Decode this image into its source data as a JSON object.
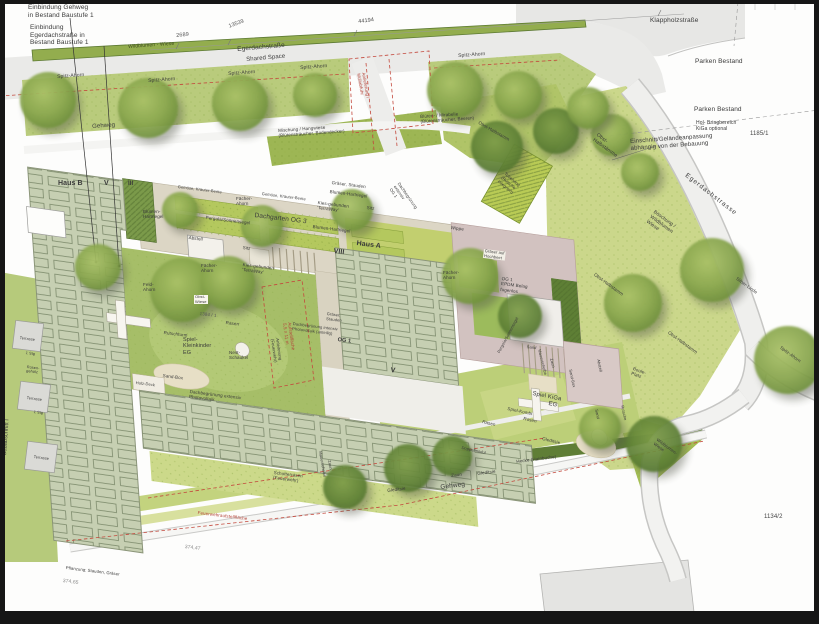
{
  "colors": {
    "street_gray": "#eaeae8",
    "lawn_green": "#cbd78b",
    "roof_sage": "#c6cfb2",
    "bed_green": "#b4c85e",
    "wildflower_strip": "#93ad4e",
    "hedge_dark": "#5f7e36",
    "epdm_mauve": "#d2c2c0",
    "annotation_red": "#b5463b"
  },
  "labels": [
    {
      "n": "note-einbindung-gehweg",
      "t": "Einbindung Gehweg\nin Bestand Baustufe 1",
      "x": 28,
      "y": 4,
      "s": 6.5
    },
    {
      "n": "note-einbindung-egerdachstrasse",
      "t": "Einbindung\nEgerdachstraße in\nBestand Baustufe 1",
      "x": 30,
      "y": 24,
      "s": 6.5
    },
    {
      "n": "dim-2689",
      "t": "2689",
      "x": 176,
      "y": 33,
      "r": -6,
      "s": 5.5,
      "c": "#555"
    },
    {
      "n": "dim-13539",
      "t": "13539",
      "x": 228,
      "y": 24,
      "r": -20,
      "s": 5.5,
      "c": "#555"
    },
    {
      "n": "dim-44194",
      "t": "44194",
      "x": 358,
      "y": 19,
      "r": -7,
      "s": 5.5,
      "c": "#444"
    },
    {
      "n": "wildblumen-wiese-top",
      "t": "Wildblumen - Wiese",
      "x": 128,
      "y": 45,
      "r": -4,
      "s": 5,
      "c": "#3c4a1e"
    },
    {
      "n": "street-egerdachstrasse",
      "t": "Egerdachstraße",
      "x": 237,
      "y": 46,
      "r": -5,
      "s": 6.5
    },
    {
      "n": "street-shared-space",
      "t": "Shared Space",
      "x": 246,
      "y": 57,
      "r": -5,
      "s": 6
    },
    {
      "n": "tree-spitz-ahorn-1",
      "t": "Spitz-Ahorn",
      "x": 57,
      "y": 75,
      "r": -4,
      "s": 5
    },
    {
      "n": "tree-spitz-ahorn-2",
      "t": "Spitz-Ahorn",
      "x": 148,
      "y": 79,
      "r": -4,
      "s": 5
    },
    {
      "n": "tree-spitz-ahorn-3",
      "t": "Spitz-Ahorn",
      "x": 228,
      "y": 72,
      "r": -4,
      "s": 5
    },
    {
      "n": "tree-spitz-ahorn-4",
      "t": "Spitz-Ahorn",
      "x": 300,
      "y": 66,
      "r": -4,
      "s": 5
    },
    {
      "n": "tree-spitz-ahorn-5",
      "t": "Spitz-Ahorn",
      "x": 458,
      "y": 54,
      "r": -4,
      "s": 5
    },
    {
      "n": "gehweg-nord",
      "t": "Gehweg",
      "x": 92,
      "y": 124,
      "r": -4,
      "s": 6
    },
    {
      "n": "street-klappholzstrasse",
      "t": "Klappholzstraße",
      "x": 650,
      "y": 17,
      "s": 6.5
    },
    {
      "n": "parken-bestand-1",
      "t": "Parken Bestand",
      "x": 695,
      "y": 58,
      "s": 6.5
    },
    {
      "n": "parken-bestand-2",
      "t": "Parken Bestand",
      "x": 694,
      "y": 106,
      "s": 6.5
    },
    {
      "n": "hol-bringbereich",
      "t": "Hol- Bringbereich\nKiGa optional",
      "x": 696,
      "y": 121,
      "s": 5
    },
    {
      "n": "parcel-1185-1",
      "t": "1185/1",
      "x": 750,
      "y": 131,
      "s": 6,
      "c": "#444"
    },
    {
      "n": "note-einschnitt",
      "t": "Einschnitt/Geländeanpassung\nabhängig von der Bebauung",
      "x": 630,
      "y": 139,
      "r": -4,
      "s": 6
    },
    {
      "n": "street-egerdachstrasse-diag",
      "t": "Egerdachstrasse",
      "x": 688,
      "y": 172,
      "r": 38,
      "s": 6.5,
      "ls": 1
    },
    {
      "n": "boeschung-wildblumen",
      "t": "Böschung /\nWildblumen\nWiese",
      "x": 655,
      "y": 210,
      "r": 36,
      "s": 5
    },
    {
      "n": "obst-halbstaemme",
      "t": "Obst-\nHalbstämme",
      "x": 598,
      "y": 133,
      "r": 36,
      "s": 5
    },
    {
      "n": "obst-halbstamm-1",
      "t": "Obst-Halbstamm",
      "x": 480,
      "y": 120,
      "r": 30,
      "s": 4.5
    },
    {
      "n": "obst-halbstamm-2",
      "t": "Obst-Halbstamm",
      "x": 596,
      "y": 272,
      "r": 36,
      "s": 4.5
    },
    {
      "n": "obst-halbstamm-3",
      "t": "Obst-Halbstamm",
      "x": 670,
      "y": 330,
      "r": 36,
      "s": 4.5
    },
    {
      "n": "tree-silber-linde",
      "t": "Silber-Linde",
      "x": 738,
      "y": 276,
      "r": 36,
      "s": 4.5
    },
    {
      "n": "tree-spitz-ahorn-6",
      "t": "Spitz-Ahorn",
      "x": 782,
      "y": 345,
      "r": 36,
      "s": 4.5
    },
    {
      "n": "anlieferung-red",
      "t": "Anlieferung /\nMüllabfuhr",
      "x": 366,
      "y": 72,
      "r": 80,
      "s": 4.5,
      "c": "#b5463b"
    },
    {
      "n": "mischung-hangwiese",
      "t": "Mischung / Hangwiese\n(Blütensträucher, Bodendecker)",
      "x": 278,
      "y": 128,
      "r": -4,
      "s": 4.5
    },
    {
      "n": "blueten-mirabelle",
      "t": "Blüten- / Mirabelle\n(Blütensträucher, Beeren)",
      "x": 420,
      "y": 114,
      "r": -4,
      "s": 4.5
    },
    {
      "n": "haus-b",
      "t": "Haus B",
      "x": 58,
      "y": 180,
      "s": 7,
      "w": 700
    },
    {
      "n": "haus-b-geschosse",
      "t": "V",
      "x": 104,
      "y": 180,
      "s": 7,
      "w": 700
    },
    {
      "n": "roemisch-iii",
      "t": "III",
      "x": 128,
      "y": 181,
      "s": 6,
      "w": 700
    },
    {
      "n": "gemuese-beete-1",
      "t": "Gemüse, Kräuter-Beete",
      "x": 178,
      "y": 185,
      "r": 7,
      "s": 4
    },
    {
      "n": "gemuese-beete-2",
      "t": "Gemüse, Kräuter-Beete",
      "x": 262,
      "y": 192,
      "r": 7,
      "s": 4
    },
    {
      "n": "pergola-sonnensegel-1",
      "t": "Pergola/Sonnensegel",
      "x": 206,
      "y": 215,
      "r": 7,
      "s": 4.5
    },
    {
      "n": "dachgarten-og3",
      "t": "Dachgarten OG 3",
      "x": 255,
      "y": 212,
      "r": 7,
      "s": 6.5
    },
    {
      "n": "blumen-hartriegel-1",
      "t": "Blumen-\nHartriegel",
      "x": 143,
      "y": 209,
      "s": 4.5
    },
    {
      "n": "graeser-stauden-1",
      "t": "Gräser, Stauden",
      "x": 332,
      "y": 180,
      "r": 7,
      "s": 4.5
    },
    {
      "n": "blumen-hartriegel-2",
      "t": "Blumen-Hartriegel",
      "x": 330,
      "y": 189,
      "r": 7,
      "s": 4.5
    },
    {
      "n": "blumen-hartriegel-3",
      "t": "Blumen-Hartriegel",
      "x": 313,
      "y": 224,
      "r": 7,
      "s": 4.5
    },
    {
      "n": "abstell-1",
      "t": "Abstell",
      "x": 189,
      "y": 235,
      "r": 7,
      "s": 4.5
    },
    {
      "n": "sitz-1",
      "t": "Sitz",
      "x": 243,
      "y": 245,
      "r": 7,
      "s": 4.5
    },
    {
      "n": "sitz-2",
      "t": "Sitz",
      "x": 367,
      "y": 205,
      "r": 7,
      "s": 4.5
    },
    {
      "n": "kies-terraway-1",
      "t": "Kies-gebunden\n'TerraWay'",
      "x": 318,
      "y": 200,
      "r": 7,
      "s": 4.5
    },
    {
      "n": "kies-terraway-2",
      "t": "Kies-gebunden\n'TerraWay'",
      "x": 243,
      "y": 262,
      "r": 7,
      "s": 4.5
    },
    {
      "n": "faecher-ahorn-1",
      "t": "Fächer-\nAhorn",
      "x": 236,
      "y": 196,
      "s": 4.5
    },
    {
      "n": "faecher-ahorn-2",
      "t": "Fächer-\nAhorn",
      "x": 201,
      "y": 263,
      "s": 4.5
    },
    {
      "n": "faecher-ahorn-3",
      "t": "Fächer-\nAhorn",
      "x": 443,
      "y": 270,
      "s": 4.5
    },
    {
      "n": "feld-ahorn",
      "t": "Feld-\nAhorn",
      "x": 143,
      "y": 282,
      "s": 4.5
    },
    {
      "n": "obst-wiese",
      "t": "Obst-\nWiese",
      "x": 194,
      "y": 295,
      "s": 4,
      "bg": "#f8f6ee"
    },
    {
      "n": "parcel-1384-1",
      "t": "1384 / 1",
      "x": 200,
      "y": 311,
      "r": 7,
      "s": 4.5,
      "c": "#555"
    },
    {
      "n": "rasen-hof",
      "t": "Rasen",
      "x": 226,
      "y": 320,
      "r": 7,
      "s": 4.5
    },
    {
      "n": "rutschturm",
      "t": "Rutschturm",
      "x": 164,
      "y": 330,
      "r": 7,
      "s": 4.5
    },
    {
      "n": "spiel-kleinkinder",
      "t": "Spiel-\nKleinkinder\nEG",
      "x": 183,
      "y": 337,
      "s": 5.5
    },
    {
      "n": "nest-schaukel",
      "t": "Nest-\nSchaukel",
      "x": 229,
      "y": 350,
      "s": 4.5
    },
    {
      "n": "sand-box-hof",
      "t": "Sand-Box",
      "x": 163,
      "y": 373,
      "r": 7,
      "s": 4.5
    },
    {
      "n": "holz-deck",
      "t": "Holz-Deck",
      "x": 136,
      "y": 381,
      "r": 7,
      "s": 4
    },
    {
      "n": "haus-a-geschosse",
      "t": "VIII",
      "x": 334,
      "y": 248,
      "r": 7,
      "s": 7,
      "w": 700
    },
    {
      "n": "haus-a",
      "t": "Haus A",
      "x": 357,
      "y": 240,
      "r": 7,
      "s": 7,
      "w": 700
    },
    {
      "n": "haus-a-v",
      "t": "V",
      "x": 391,
      "y": 367,
      "r": 7,
      "s": 7,
      "w": 700
    },
    {
      "n": "og1-haus-a",
      "t": "OG 1",
      "x": 338,
      "y": 337,
      "r": 7,
      "s": 5.5,
      "w": 700
    },
    {
      "n": "dachbegruenung-intensiv",
      "t": "Dachbegrünung intensiv\nPhotovoltaik (anteilig)",
      "x": 293,
      "y": 322,
      "r": 7,
      "s": 4
    },
    {
      "n": "graeser-stauden-2",
      "t": "Gräser,\nStauden",
      "x": 327,
      "y": 312,
      "r": 7,
      "s": 4
    },
    {
      "n": "dachbegruenung-extensiv-og1",
      "t": "Dachbegrünung\nextensiv\nOG 1",
      "x": 400,
      "y": 182,
      "r": 55,
      "s": 4.2
    },
    {
      "n": "wippe",
      "t": "Wippe",
      "x": 451,
      "y": 225,
      "r": 7,
      "s": 4.5
    },
    {
      "n": "graeser-hochbeet",
      "t": "Gräser auf\nHochbeet",
      "x": 484,
      "y": 249,
      "r": 7,
      "s": 4,
      "bg": "#f2f0e7"
    },
    {
      "n": "og1-epdm",
      "t": "OG 1\nEPDM Belag\nfugenlos",
      "x": 502,
      "y": 276,
      "r": 7,
      "s": 4.5
    },
    {
      "n": "tobehang",
      "t": "Tobehang\n(Rutsche\nintegriert)",
      "x": 506,
      "y": 172,
      "r": 40,
      "s": 4.2
    },
    {
      "n": "pergola-sonnensegel-2",
      "t": "Pergola/Sonnensegel",
      "x": 497,
      "y": 352,
      "r": -62,
      "s": 4
    },
    {
      "n": "sand-terrasse",
      "t": "Sand",
      "x": 527,
      "y": 345,
      "r": 7,
      "s": 4
    },
    {
      "n": "aufstellflaeche-red",
      "t": "Aufstellfläche\n5,5 x 11 m",
      "x": 292,
      "y": 322,
      "r": 82,
      "s": 4.5,
      "c": "#b5463b"
    },
    {
      "n": "anleiterung-feuerwehr",
      "t": "Anleiterung\n(Feuerwehr)",
      "x": 279,
      "y": 338,
      "r": 82,
      "s": 4.2
    },
    {
      "n": "dachbegruenung-pv",
      "t": "Dachbegrünung extensiv\nPhotovoltaik",
      "x": 190,
      "y": 389,
      "r": 7,
      "s": 4.5
    },
    {
      "n": "schotterrasen",
      "t": "Schotterrasen\n(Feuerwehr)",
      "x": 274,
      "y": 470,
      "r": 7,
      "s": 4.5
    },
    {
      "n": "feuerwehraufstellflaeche-red",
      "t": "Feuerwehraufstellfläche",
      "x": 198,
      "y": 510,
      "r": 7,
      "s": 4.5,
      "c": "#b5463b"
    },
    {
      "n": "mauerscheibe-1",
      "t": "Mauerscheibe",
      "x": 322,
      "y": 451,
      "r": 80,
      "s": 4
    },
    {
      "n": "zaun-1",
      "t": "Zaun",
      "x": 331,
      "y": 460,
      "r": 80,
      "s": 4
    },
    {
      "n": "mauerscheibe-2",
      "t": "Mauerscheibe",
      "x": 541,
      "y": 349,
      "r": 76,
      "s": 4
    },
    {
      "n": "zaun-2",
      "t": "Zaun",
      "x": 553,
      "y": 358,
      "r": 76,
      "s": 4
    },
    {
      "n": "hecke-hainbuche",
      "t": "Hecke (Hainbuche)",
      "x": 516,
      "y": 459,
      "r": -7,
      "s": 4.5
    },
    {
      "n": "zaun-3",
      "t": "Zaun",
      "x": 451,
      "y": 473,
      "r": -7,
      "s": 4.5
    },
    {
      "n": "gleditsie-1",
      "t": "Gleditsie",
      "x": 477,
      "y": 471,
      "r": -7,
      "s": 4.5
    },
    {
      "n": "gleditsie-2",
      "t": "Gleditsie",
      "x": 387,
      "y": 488,
      "r": -7,
      "s": 4.5
    },
    {
      "n": "gleditsie-3",
      "t": "Gleditsie",
      "x": 543,
      "y": 436,
      "r": 14,
      "s": 4.5
    },
    {
      "n": "gehweg-sued",
      "t": "Gehweg",
      "x": 440,
      "y": 484,
      "r": -7,
      "s": 6.5
    },
    {
      "n": "rasen-kiga",
      "t": "Rasen",
      "x": 483,
      "y": 419,
      "r": 14,
      "s": 4.5
    },
    {
      "n": "spiel-kombi",
      "t": "Spiel-Kombi",
      "x": 508,
      "y": 406,
      "r": 12,
      "s": 4.5
    },
    {
      "n": "spiel-kiga",
      "t": "Spiel KiGa",
      "x": 533,
      "y": 391,
      "r": 11,
      "s": 6
    },
    {
      "n": "spiel-kiga-eg",
      "t": "EG",
      "x": 549,
      "y": 401,
      "r": 11,
      "s": 6
    },
    {
      "n": "doppelmodul",
      "t": "Doppelmodul",
      "x": 462,
      "y": 446,
      "r": 12,
      "s": 4
    },
    {
      "n": "rosen",
      "t": "Rosen",
      "x": 524,
      "y": 416,
      "r": 12,
      "s": 4.5
    },
    {
      "n": "sand-box-kiga",
      "t": "Sand-Box",
      "x": 572,
      "y": 369,
      "r": 78,
      "s": 4
    },
    {
      "n": "abstell-2",
      "t": "Abstell",
      "x": 600,
      "y": 359,
      "r": 78,
      "s": 4
    },
    {
      "n": "sand-kiga",
      "t": "Sand",
      "x": 598,
      "y": 409,
      "r": 78,
      "s": 4
    },
    {
      "n": "rutsche-kiga",
      "t": "Rutsche",
      "x": 624,
      "y": 405,
      "r": 78,
      "s": 4
    },
    {
      "n": "wildblumen-wiese-sued",
      "t": "Wildblumen-\nWiese",
      "x": 658,
      "y": 438,
      "r": 36,
      "s": 4.2
    },
    {
      "n": "boule-platz",
      "t": "Boule-\nPlatz",
      "x": 634,
      "y": 366,
      "r": 20,
      "s": 4.5
    },
    {
      "n": "parcel-1134-2",
      "t": "1134/2",
      "x": 764,
      "y": 514,
      "s": 6,
      "c": "#444"
    },
    {
      "n": "bauabschnitt-1",
      "t": "Bauabschnitt I",
      "x": 2,
      "y": 455,
      "r": -86,
      "s": 5.5
    },
    {
      "n": "terrasse-1",
      "t": "Terrasse",
      "x": 20,
      "y": 336,
      "r": 7,
      "s": 3.8
    },
    {
      "n": "terrasse-2",
      "t": "Terrasse",
      "x": 27,
      "y": 396,
      "r": 7,
      "s": 3.8
    },
    {
      "n": "terrasse-3",
      "t": "Terrasse",
      "x": 34,
      "y": 455,
      "r": 7,
      "s": 3.8
    },
    {
      "n": "stiege-1",
      "t": "1 Stg",
      "x": 26,
      "y": 351,
      "r": 7,
      "s": 3.8
    },
    {
      "n": "stiege-2",
      "t": "1 Stg",
      "x": 34,
      "y": 410,
      "r": 7,
      "s": 3.8
    },
    {
      "n": "rosen-gehoelz",
      "t": "Rosen-\ngehölz",
      "x": 27,
      "y": 365,
      "r": 7,
      "s": 3.8
    },
    {
      "n": "rasen-streifen",
      "t": "Rasen-\nstreifen",
      "x": 4,
      "y": 385,
      "r": 80,
      "s": 3.8
    },
    {
      "n": "hoehe-374-47",
      "t": "374,47",
      "x": 185,
      "y": 545,
      "r": 7,
      "s": 5,
      "c": "#888"
    },
    {
      "n": "hoehe-374-65",
      "t": "374,65",
      "x": 63,
      "y": 579,
      "r": 7,
      "s": 5,
      "c": "#888"
    },
    {
      "n": "pflanzung-stauden",
      "t": "Pflanzung: Stauden, Gräser",
      "x": 66,
      "y": 566,
      "r": 7,
      "s": 4.2
    }
  ]
}
